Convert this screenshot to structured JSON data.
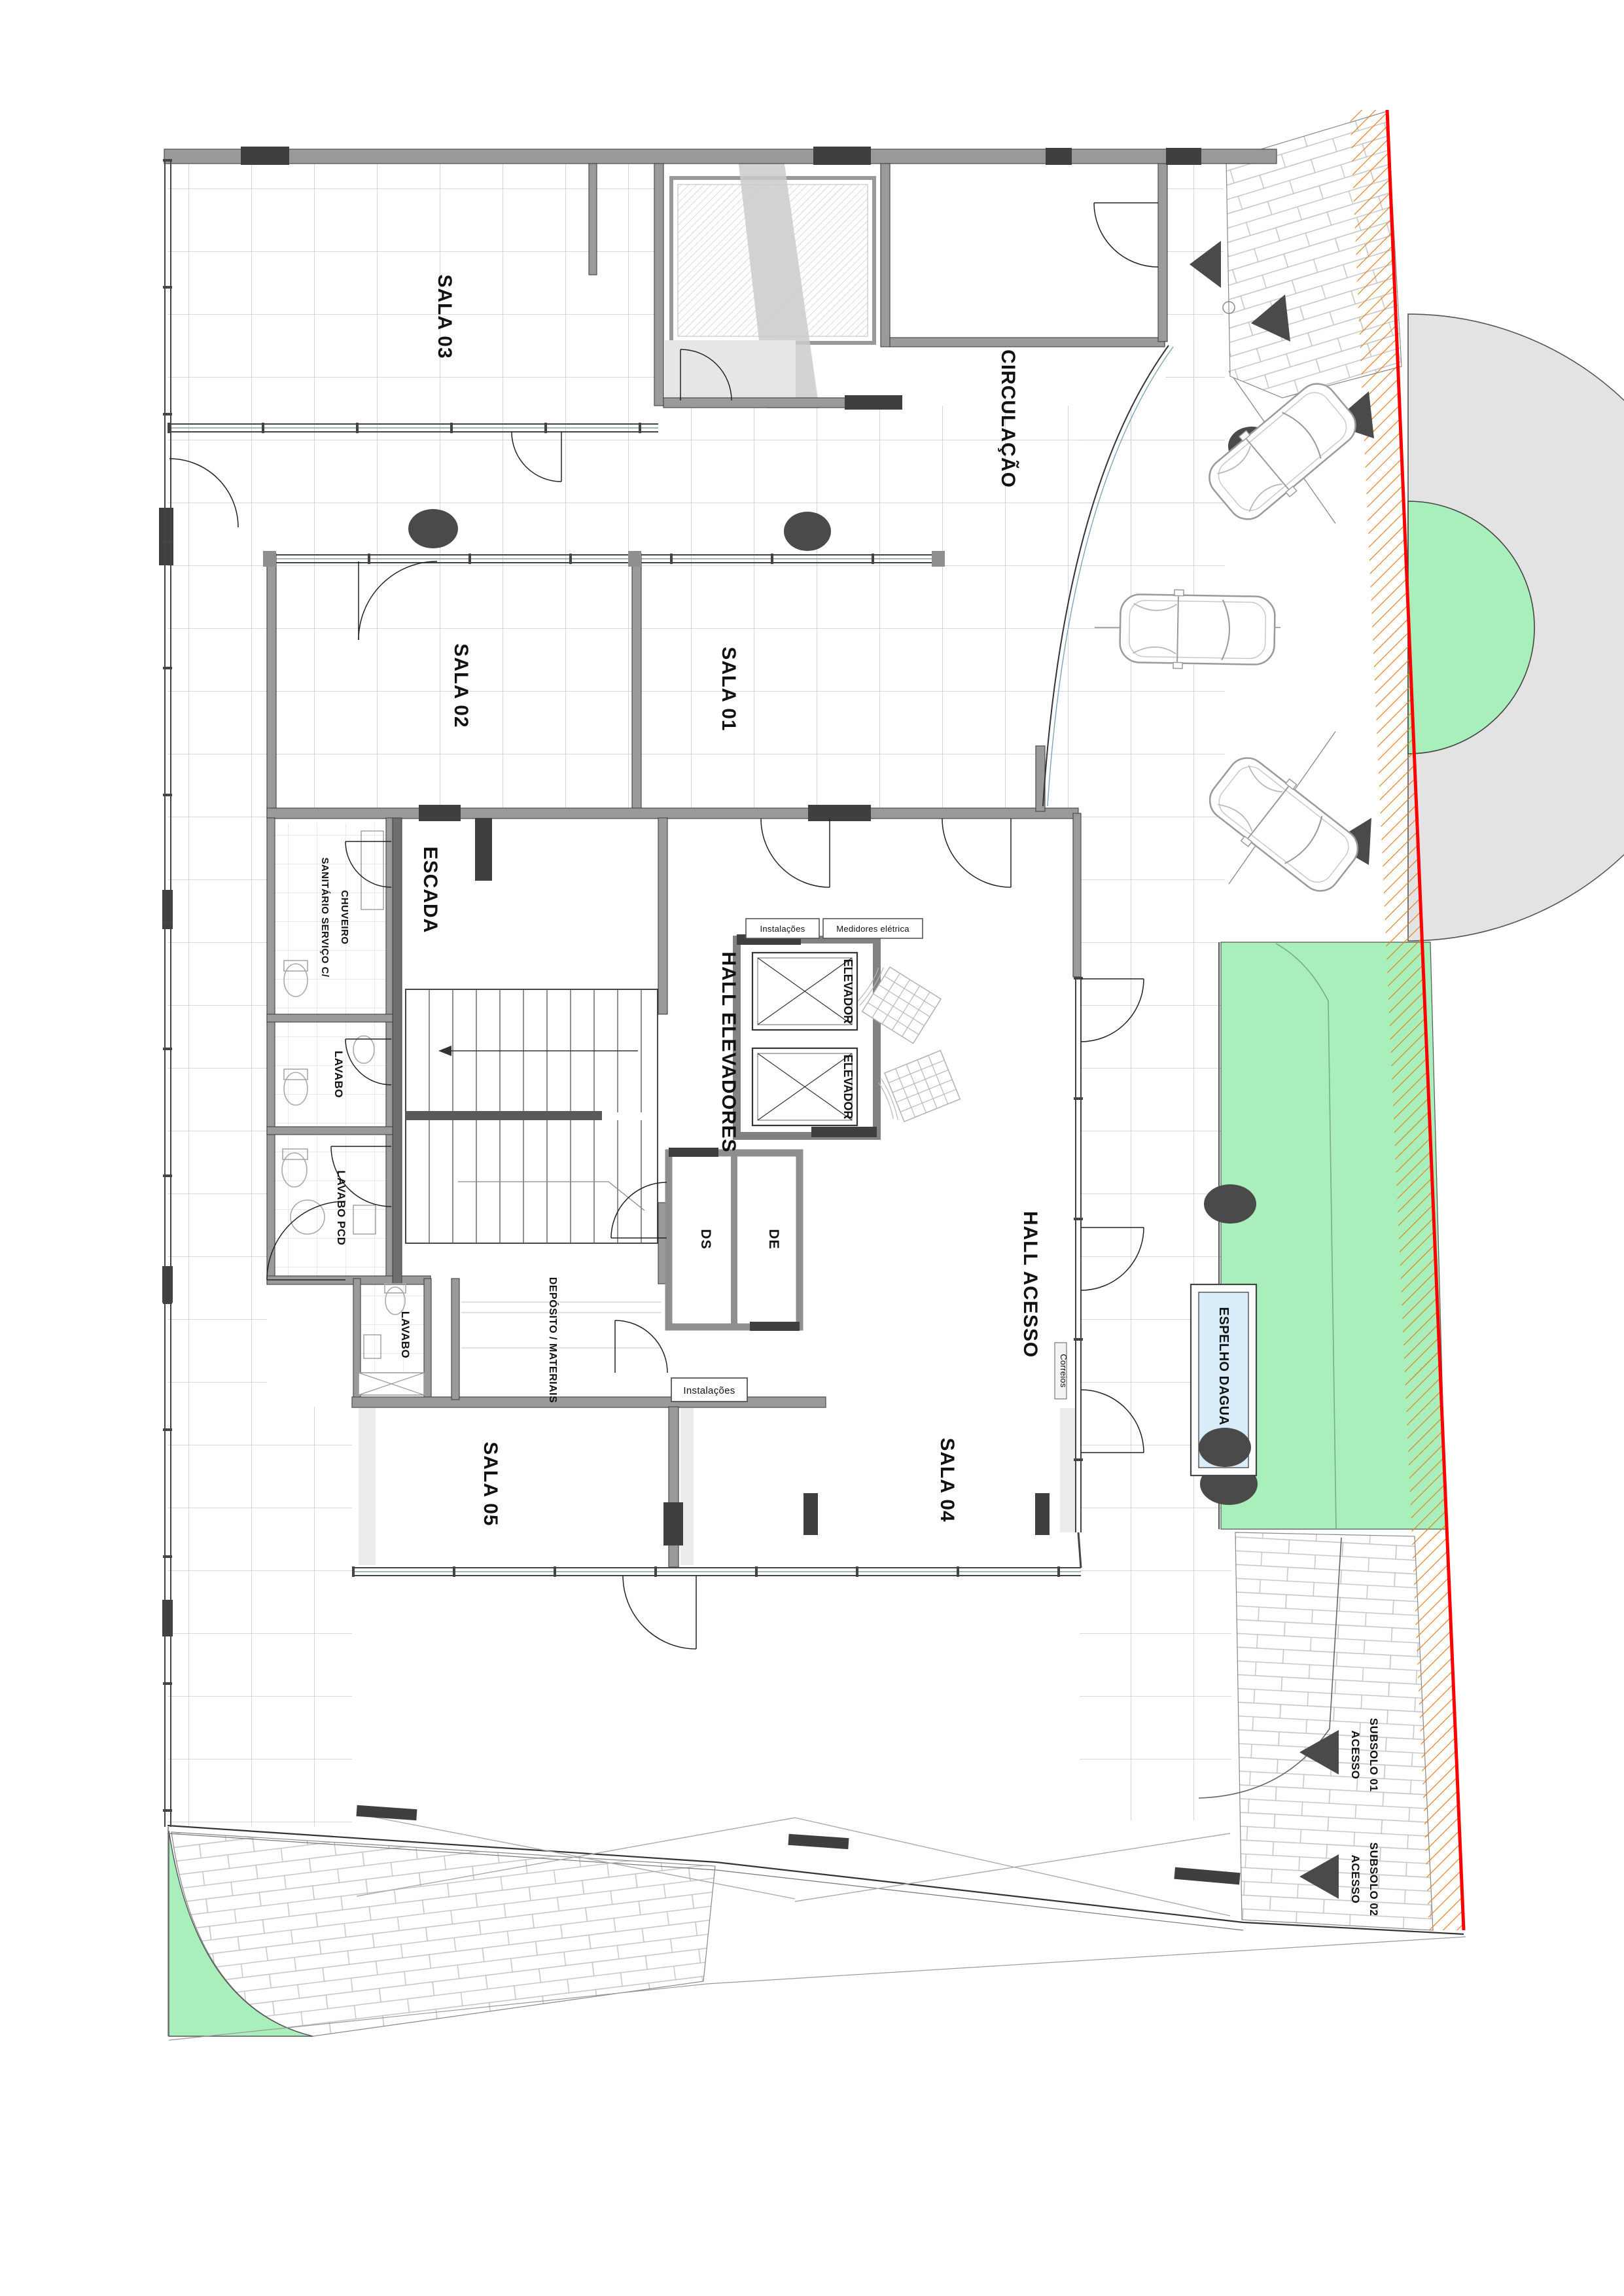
{
  "rooms": {
    "sala01": "SALA 01",
    "sala02": "SALA 02",
    "sala03": "SALA 03",
    "sala04": "SALA 04",
    "sala05": "SALA 05",
    "circulacao": "CIRCULAÇÃO",
    "escada": "ESCADA",
    "hall_elevadores": "HALL ELEVADORES",
    "hall_acesso": "HALL ACESSO",
    "deposito": "DEPÓSITO / MATERIAIS",
    "sanitario_l1": "SANITÁRIO SERVIÇO C/",
    "sanitario_l2": "CHUVEIRO",
    "lavabo_sup": "LAVABO",
    "lavabo_pcd": "LAVABO PCD",
    "lavabo_inf": "LAVABO",
    "ds": "DS",
    "de": "DE",
    "elevador_1": "ELEVADOR",
    "elevador_2": "ELEVADOR"
  },
  "annex": {
    "instalacoes_1": "Instalações",
    "medidores": "Medidores elétrica",
    "instalacoes_2": "Instalações",
    "correios": "Correios"
  },
  "site": {
    "espelho_dagua": "ESPELHO DAGUA",
    "acesso_subsolo_01_l1": "ACESSO",
    "acesso_subsolo_01_l2": "SUBSOLO 01",
    "acesso_subsolo_02_l1": "ACESSO",
    "acesso_subsolo_02_l2": "SUBSOLO 02"
  },
  "colors": {
    "lawn": "#a9efbb",
    "water": "#d9ecf9",
    "asphalt": "#e3e3e3",
    "property_line": "#ff0000",
    "hatch_orange": "#e2801c",
    "wall": "#9a9a9a",
    "wall_dark": "#3f3f3f",
    "grid_line": "#c7cbd1"
  }
}
